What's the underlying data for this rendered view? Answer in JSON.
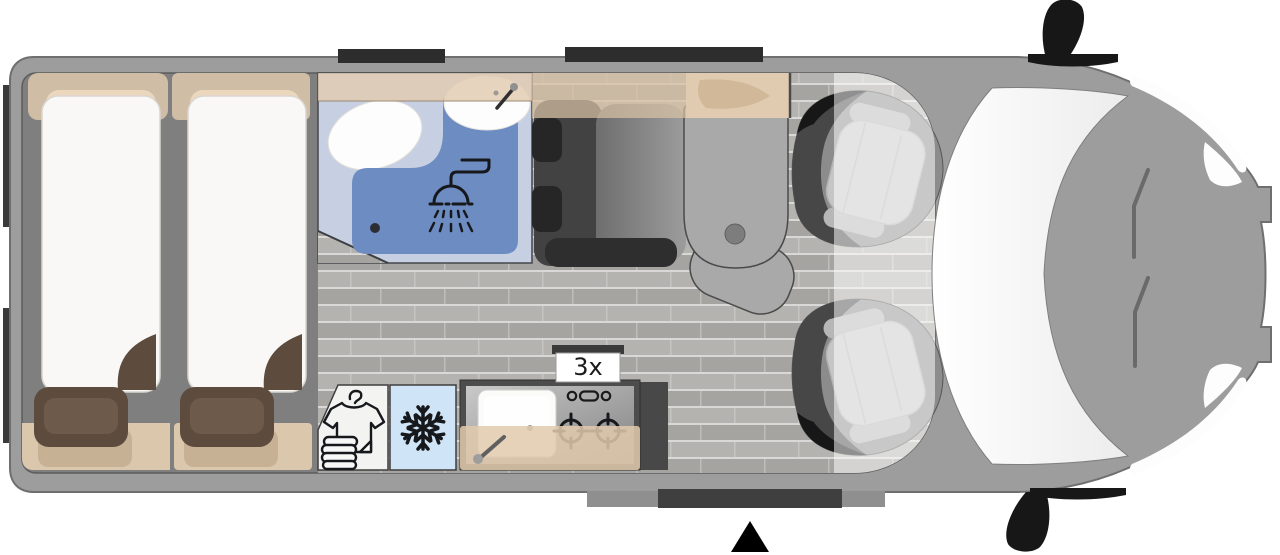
{
  "title": "Campervan floor plan (top view)",
  "labels": {
    "burner_count": "3x"
  },
  "features": [
    "twin-rear-beds",
    "bathroom-with-shower-and-toilet",
    "washbasin",
    "wardrobe",
    "refrigerator",
    "kitchen-galley-with-sink-and-2-burner-hob",
    "lounge-bench-seat",
    "pedestal-table",
    "swivel-cab-seat-driver",
    "swivel-cab-seat-passenger",
    "sliding-entry-door",
    "rear-doors",
    "windshield",
    "side-mirrors",
    "roof-windows"
  ],
  "colors": {
    "body": "#9d9d9d",
    "body_line": "#6f6f6f",
    "wall": "#7f7f7f",
    "bar_dark": "#2d2d2d",
    "door_bar": "#3b3b3b",
    "floor_a": "#b5b3b0",
    "floor_b": "#a6a4a1",
    "floor_gap": "#d9d8d6",
    "bed_white": "#f9f8f6",
    "bed_line": "#d9d5cf",
    "band_beige": "#cfbda6",
    "pillow": "#ead7be",
    "blanket": "#5d4b3d",
    "blanket_hi": "#6d5a4a",
    "bench": "#dac7ac",
    "bench_cushion": "#c7b195",
    "bath_floor": "#c7d0e2",
    "shower": "#6d8cc2",
    "fixture_white": "#fdfdfd",
    "icon_dark": "#16181c",
    "wardrobe_bg": "#f3f3f1",
    "fridge_bg": "#cfe4f6",
    "counter_dark": "#4d4d4d",
    "sink_white": "#fbfbfa",
    "overlay_beige": "rgba(226,202,173,0.85)",
    "band_translucent": "rgba(216,192,163,0.72)",
    "seat_back": "#424242",
    "seat_darker": "#262626",
    "table": "#a9a9a9",
    "line": "#4a4a4a",
    "cab_seat_base": "#8c8c8c",
    "cab_seat_dark": "#474747",
    "cab_seat_black": "#171717",
    "cab_cushion": "#c6c6c6",
    "overlay_white": "rgba(255,255,255,0.52)",
    "label_bg": "#ffffff",
    "label_text": "#1a1a1a",
    "black": "#000000"
  }
}
